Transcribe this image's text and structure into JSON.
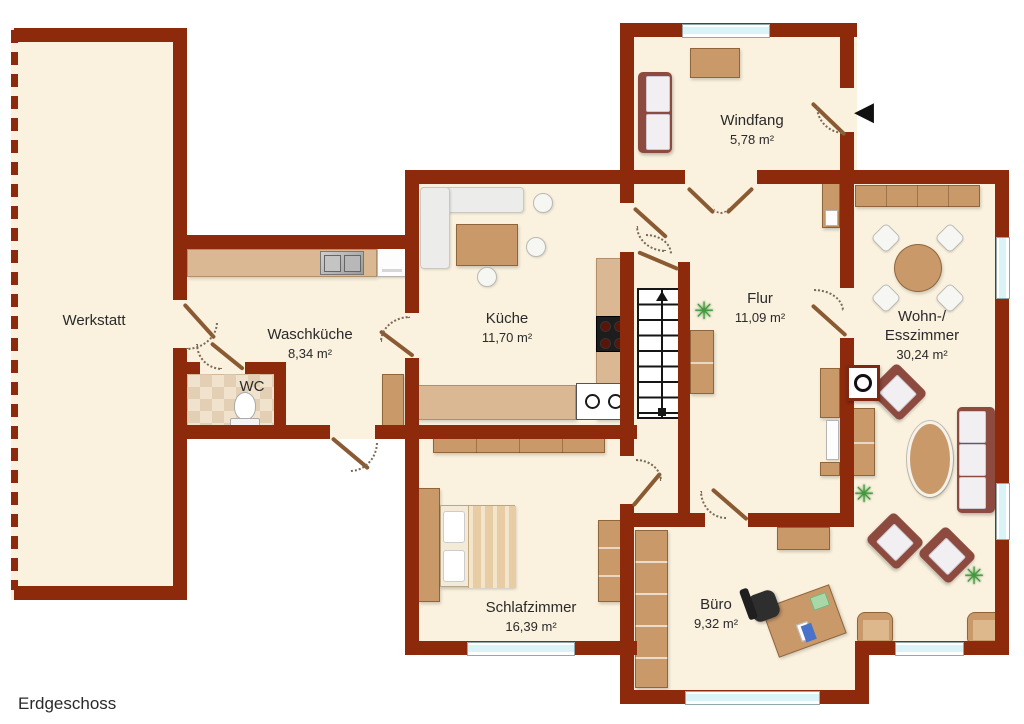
{
  "title": "Erdgeschoss",
  "rooms": [
    {
      "id": "werkstatt",
      "name": "Werkstatt",
      "area": ""
    },
    {
      "id": "waschkueche",
      "name": "Waschküche",
      "area": "8,34 m²"
    },
    {
      "id": "wc",
      "name": "WC",
      "area": ""
    },
    {
      "id": "kueche",
      "name": "Küche",
      "area": "11,70 m²"
    },
    {
      "id": "windfang",
      "name": "Windfang",
      "area": "5,78 m²"
    },
    {
      "id": "flur",
      "name": "Flur",
      "area": "11,09 m²"
    },
    {
      "id": "wohn_esszimmer",
      "name": "Wohn-/\nEsszimmer",
      "area": "30,24 m²"
    },
    {
      "id": "schlafzimmer",
      "name": "Schlafzimmer",
      "area": "16,39 m²"
    },
    {
      "id": "buero",
      "name": "Büro",
      "area": "9,32 m²"
    }
  ],
  "icons": {
    "entrance_arrow": "◀",
    "plant": "✳"
  },
  "furniture": {
    "windfang": [
      "bench",
      "doormat"
    ],
    "waschkueche": [
      "counter",
      "double-sink",
      "washing-machine",
      "cabinet"
    ],
    "wc": [
      "toilet",
      "tiled-floor"
    ],
    "kueche": [
      "corner-bench",
      "dining-table",
      "chairs",
      "stove",
      "counters",
      "double-sink"
    ],
    "flur": [
      "staircase-up",
      "sideboard",
      "shelf",
      "plant"
    ],
    "wohn_esszimmer": [
      "sideboard",
      "round-dining-table",
      "four-chairs",
      "wood-stove",
      "sofa",
      "armchairs",
      "oval-coffee-table",
      "plants",
      "tv-desk"
    ],
    "schlafzimmer": [
      "wardrobe",
      "double-bed",
      "dresser"
    ],
    "buero": [
      "bookshelf",
      "sideboard",
      "desk",
      "office-chair"
    ]
  },
  "colors": {
    "wall": "#8e2a0c",
    "floor": "#faf1de",
    "wood": "#c9996a",
    "counter": "#d9b893",
    "glass": "#d9f3f6",
    "sofa": "#8d4a3f",
    "cushion": "#f2eff3",
    "text": "#2a2a2a",
    "tile_a": "#f0e2cc",
    "tile_b": "#e3d0b4",
    "door_leaf": "#8a5a33",
    "arc": "#7b6a55"
  }
}
